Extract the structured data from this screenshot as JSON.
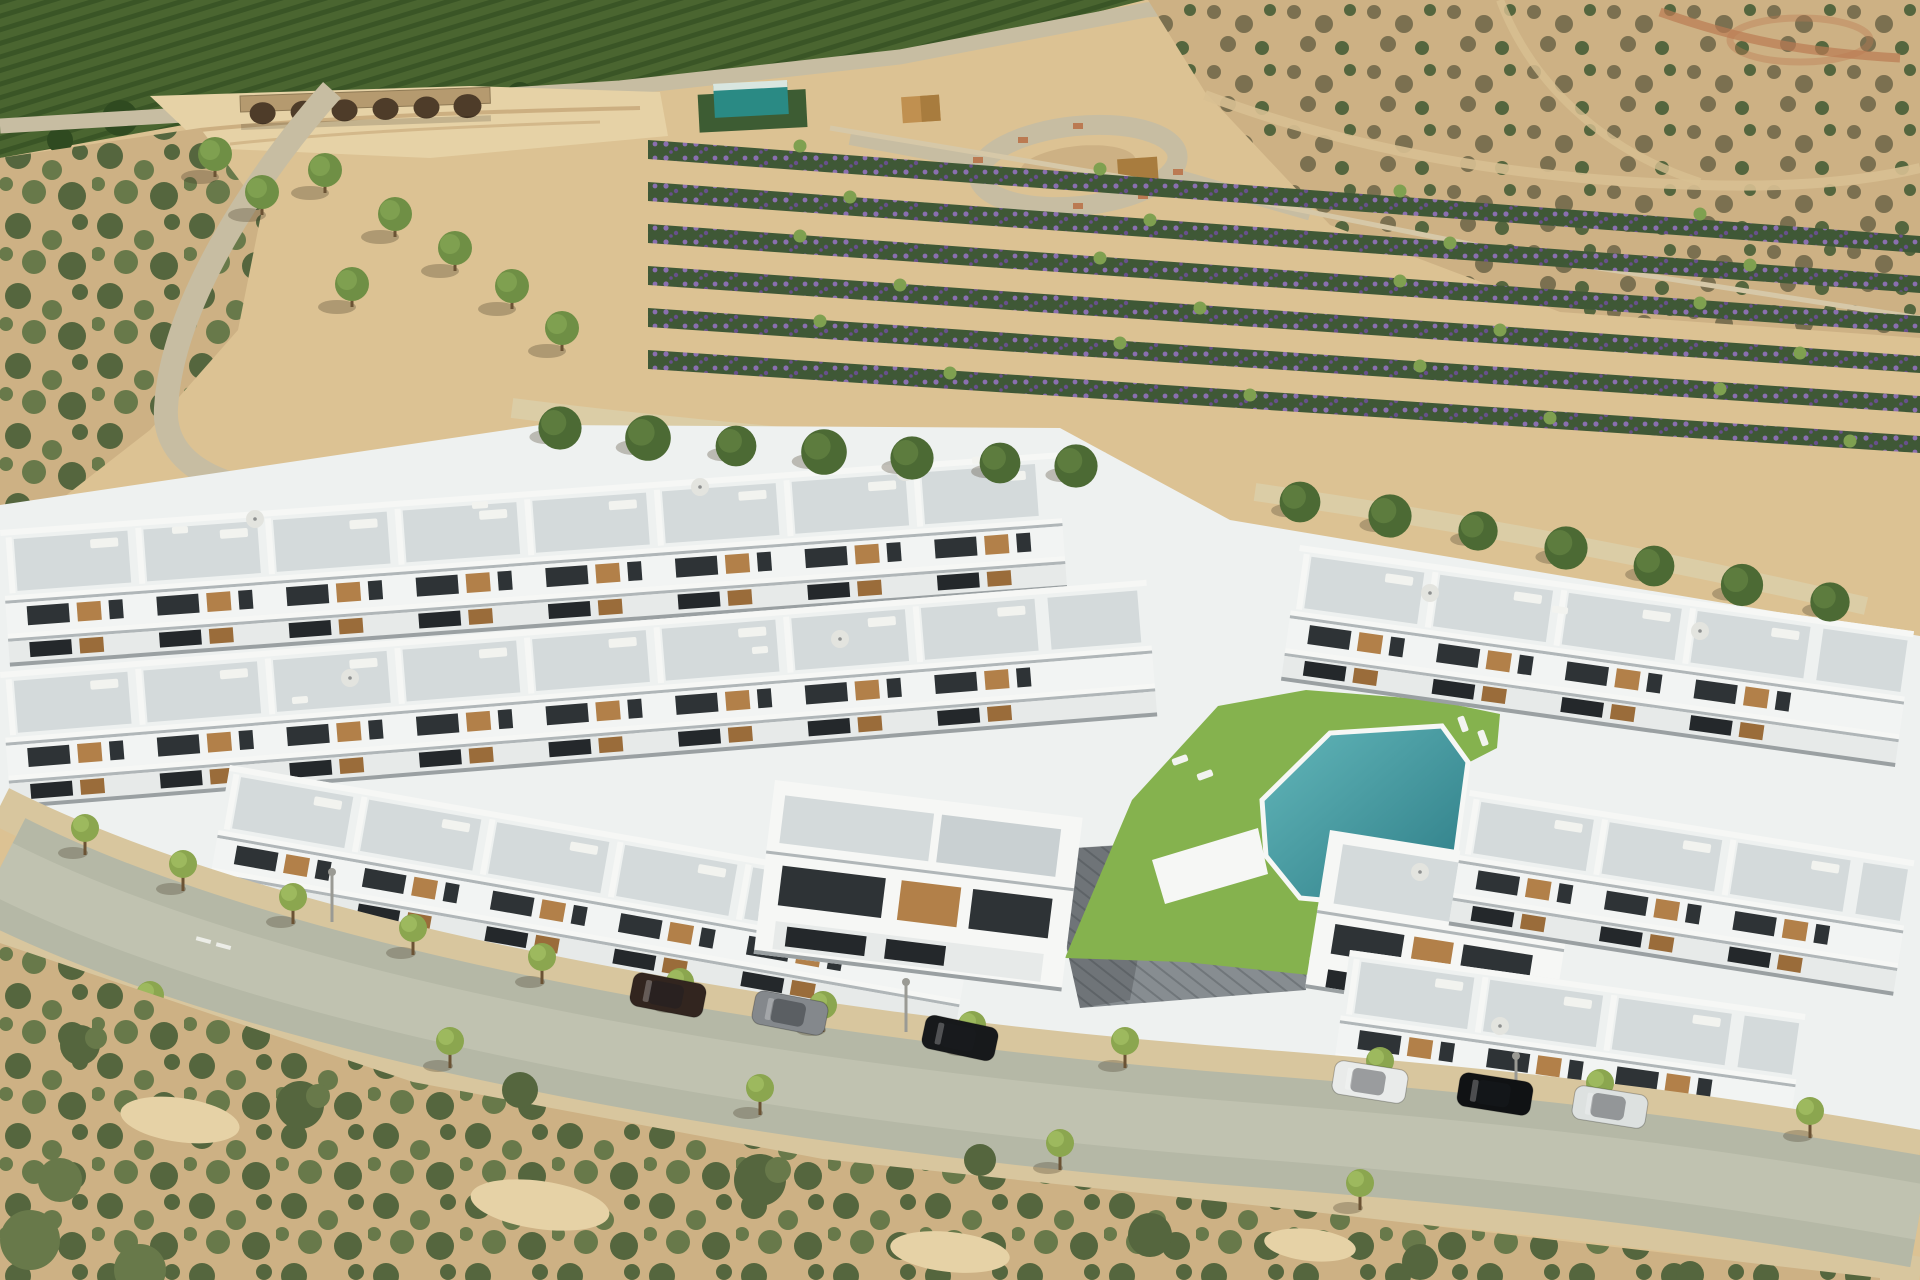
{
  "meta": {
    "alt": "Aerial 3D rendering of a modern white residential complex with rooftop terraces, a communal lawn and angular swimming pool, paved plazas, a tree-lined street with parked cars, surrounded by a dry dirt field, an orchard hillside with a stone arch bridge, diagonal rows of flowering shrubs, a roundabout and Mediterranean scrubland"
  },
  "palette": {
    "sand": "#dcc293",
    "sandLight": "#e6d2a6",
    "dirtPath": "#d8c092",
    "gully": "#c6a678",
    "orchardBase": "#4a6530",
    "orchardRow": "#3a5526",
    "orchardDark": "#2f4a20",
    "scrubBase": "#cdb184",
    "scrubDark": "#55663e",
    "scrubMid": "#68794a",
    "scrubBrown": "#7b7050",
    "roadUpper": "#c7bda2",
    "roadMain": "#b5b8a6",
    "roadWorn": "#c6c8b6",
    "walk": "#d8c69e",
    "bridgeStone": "#b59a6f",
    "bridgeArch": "#4e3c29",
    "flowerGreen": "#3f5836",
    "flowerPurple": "#8a6fb0",
    "flowerPurpleD": "#67508c",
    "teal": "#2a8a84",
    "tealRoof": "#d8e6e0",
    "hedge": "#3d5c33",
    "ochre": "#c09050",
    "ochre2": "#a87c3e",
    "redPath": "#bb7a52",
    "fenceTan": "#d6c8a8",
    "pathLight": "#dbcda6",
    "pine": "#4c6a34",
    "pineLight": "#5d7c3e",
    "treeField": "#6f8f45",
    "treeFieldL": "#7fa050",
    "treeStreet": "#8ba64f",
    "treeStreetL": "#9db95e",
    "trunk": "#6b5334",
    "lawn": "#85b24e",
    "poolLight": "#63b7ba",
    "poolDark": "#2c7b85",
    "white": "#f6f7f5",
    "blockBase": "#eef1f0",
    "face": "#f2f4f3",
    "face2": "#e7eae9",
    "terrace": "#d4dadb",
    "terrace2": "#c9d0d2",
    "shade": "#b0b6b8",
    "shadow2": "#9aa0a2",
    "glass": "#2e3336",
    "glass2": "#24282b",
    "wood": "#b28049",
    "woodD": "#9a6c3a",
    "tileBase": "#878d91",
    "tileLine": "#70767a",
    "wallWhite": "#f4f5f2",
    "lampc": "#9a9a94",
    "parasol": "#e3e4df",
    "parasolDot": "#8e9090",
    "lounger": "#f2f3ef",
    "carDark": "#32251f",
    "carGrey": "#84888c",
    "carBlack": "#17191b",
    "carWhite": "#e9ebea",
    "carBlack2": "#101214",
    "carWhite2": "#dde1e0",
    "shadowT": "rgba(70,60,40,0.30)"
  },
  "scene": {
    "features": [
      "orchard hillside",
      "stone arch bridge",
      "dirt field",
      "flower nursery rows",
      "roundabout",
      "teal utility cabin",
      "pine walkway",
      "white apartment rows with roof terraces",
      "communal lawn",
      "swimming pool",
      "tiled plaza",
      "tree-lined street",
      "parked cars",
      "scrubland foreground"
    ],
    "counts": {
      "bridge_arches": 6,
      "flower_rows": 6,
      "pine_trees": 14,
      "field_trees": 8,
      "street_trees": 17,
      "street_lamps": 3,
      "parked_cars": 6,
      "roof_parasols": 9,
      "building_rows": 8,
      "townhouse_units": 32
    },
    "vehicles": [
      {
        "type": "suv",
        "color": "#32251f"
      },
      {
        "type": "suv",
        "color": "#84888c"
      },
      {
        "type": "sedan",
        "color": "#17191b"
      },
      {
        "type": "hatchback",
        "color": "#e9ebea"
      },
      {
        "type": "suv",
        "color": "#101214"
      },
      {
        "type": "suv",
        "color": "#dde1e0"
      }
    ],
    "pool": {
      "shape": "angular",
      "color_light": "#63b7ba",
      "color_deep": "#2c7b85"
    }
  }
}
